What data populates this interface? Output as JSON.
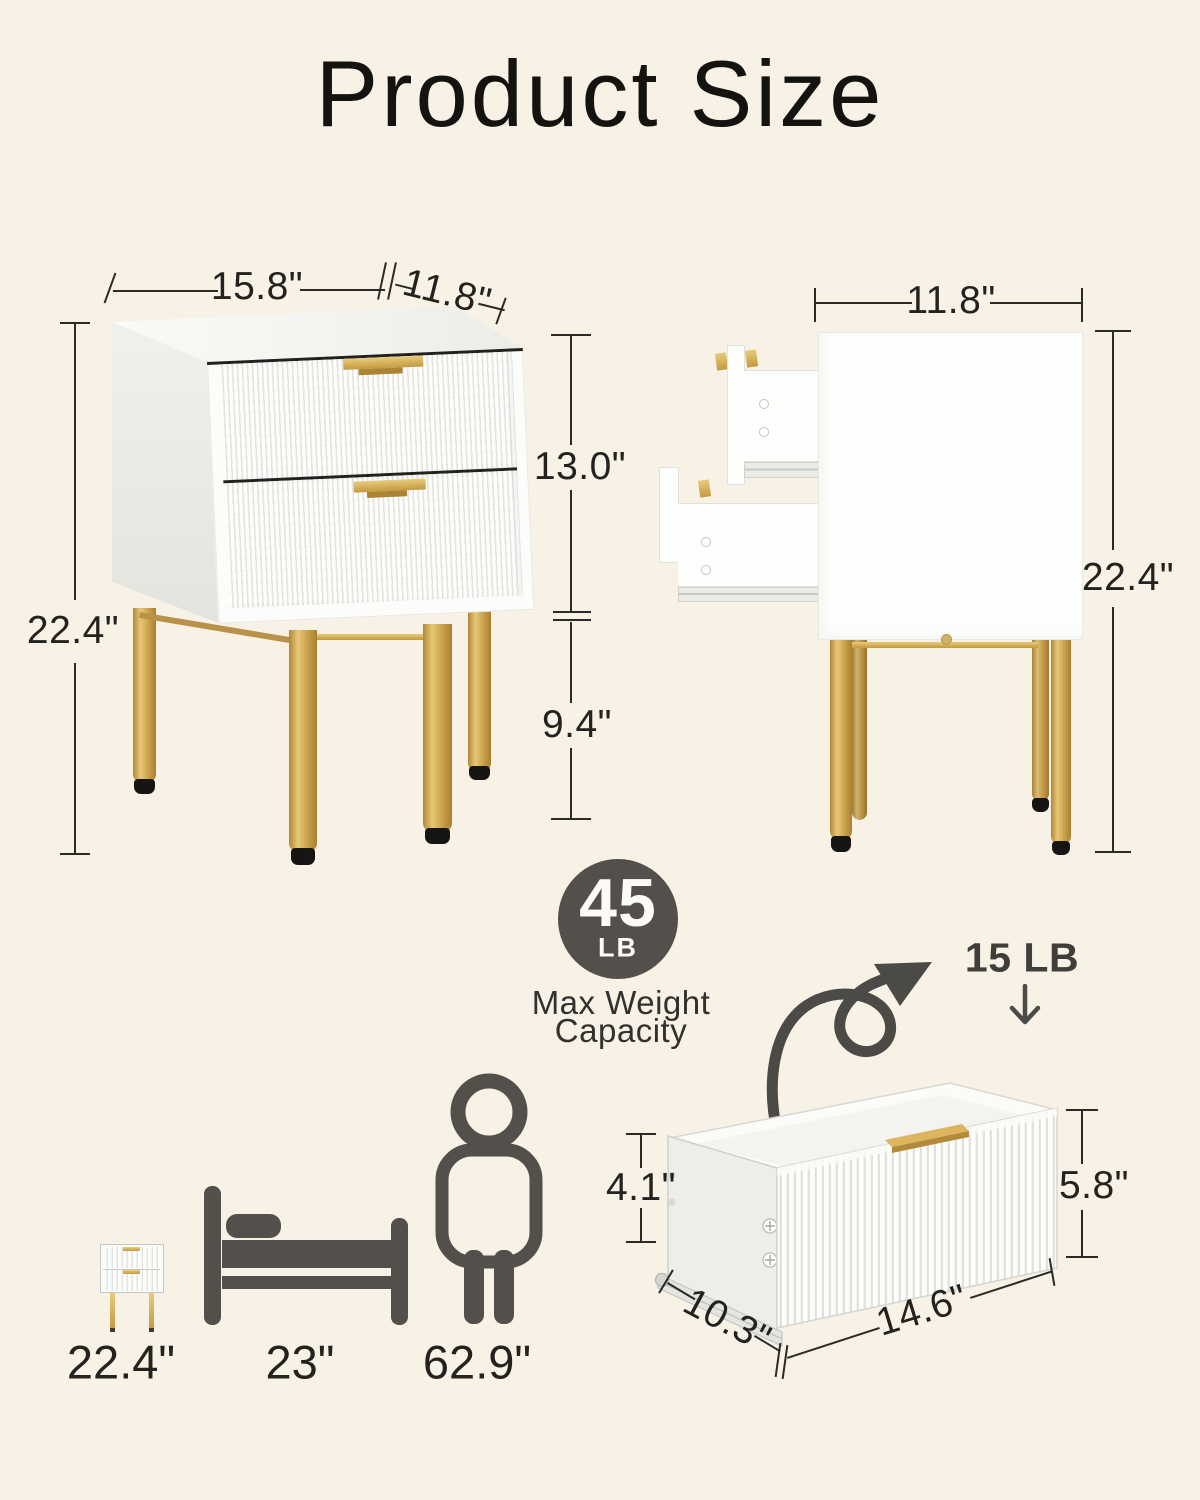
{
  "page": {
    "title": "Product Size"
  },
  "front_view": {
    "width": "15.8\"",
    "depth": "11.8\"",
    "height": "22.4\"",
    "cabinet_height": "13.0\"",
    "leg_height": "9.4\""
  },
  "side_view": {
    "depth": "11.8\"",
    "height": "22.4\""
  },
  "weight_badge": {
    "value": "45",
    "unit": "LB",
    "caption_line1": "Max Weight",
    "caption_line2": "Capacity"
  },
  "drawer_view": {
    "load": "15 LB",
    "side_height": "4.1\"",
    "front_height": "5.8\"",
    "depth": "10.3\"",
    "width": "14.6\""
  },
  "comparison": {
    "nightstand": "22.4\"",
    "bed": "23\"",
    "person": "62.9\""
  },
  "colors": {
    "background": "#f8f1e6",
    "text": "#262523",
    "icon": "#53504c",
    "gold": "#d0a94f"
  }
}
